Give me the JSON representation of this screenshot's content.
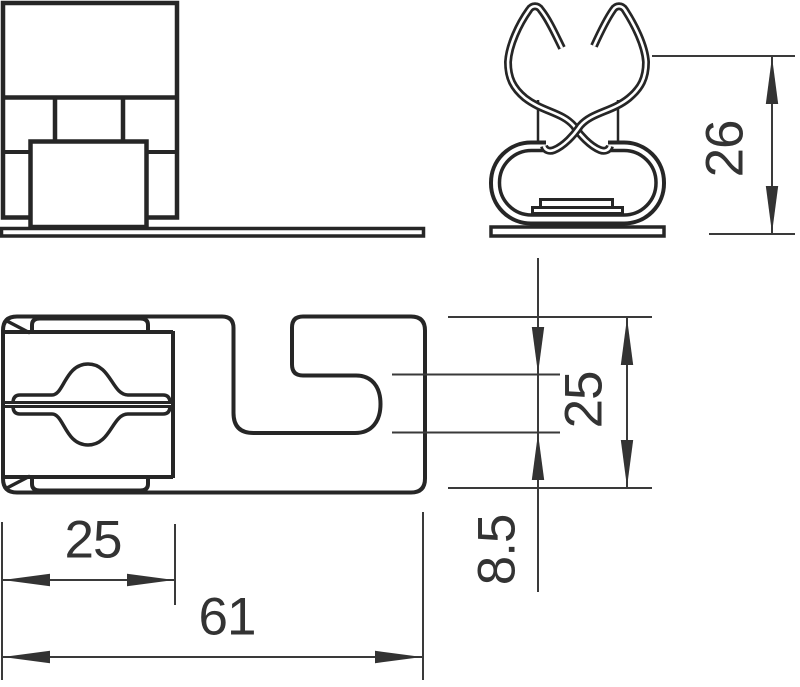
{
  "dimensions": {
    "clip_height": "26",
    "body_depth": "25",
    "slot_height": "8.5",
    "clamp_width": "25",
    "overall_width": "61"
  },
  "colors": {
    "background": "#ffffff",
    "object_line": "#262626",
    "dimension_line": "#3a3a3a",
    "text": "#333333"
  }
}
